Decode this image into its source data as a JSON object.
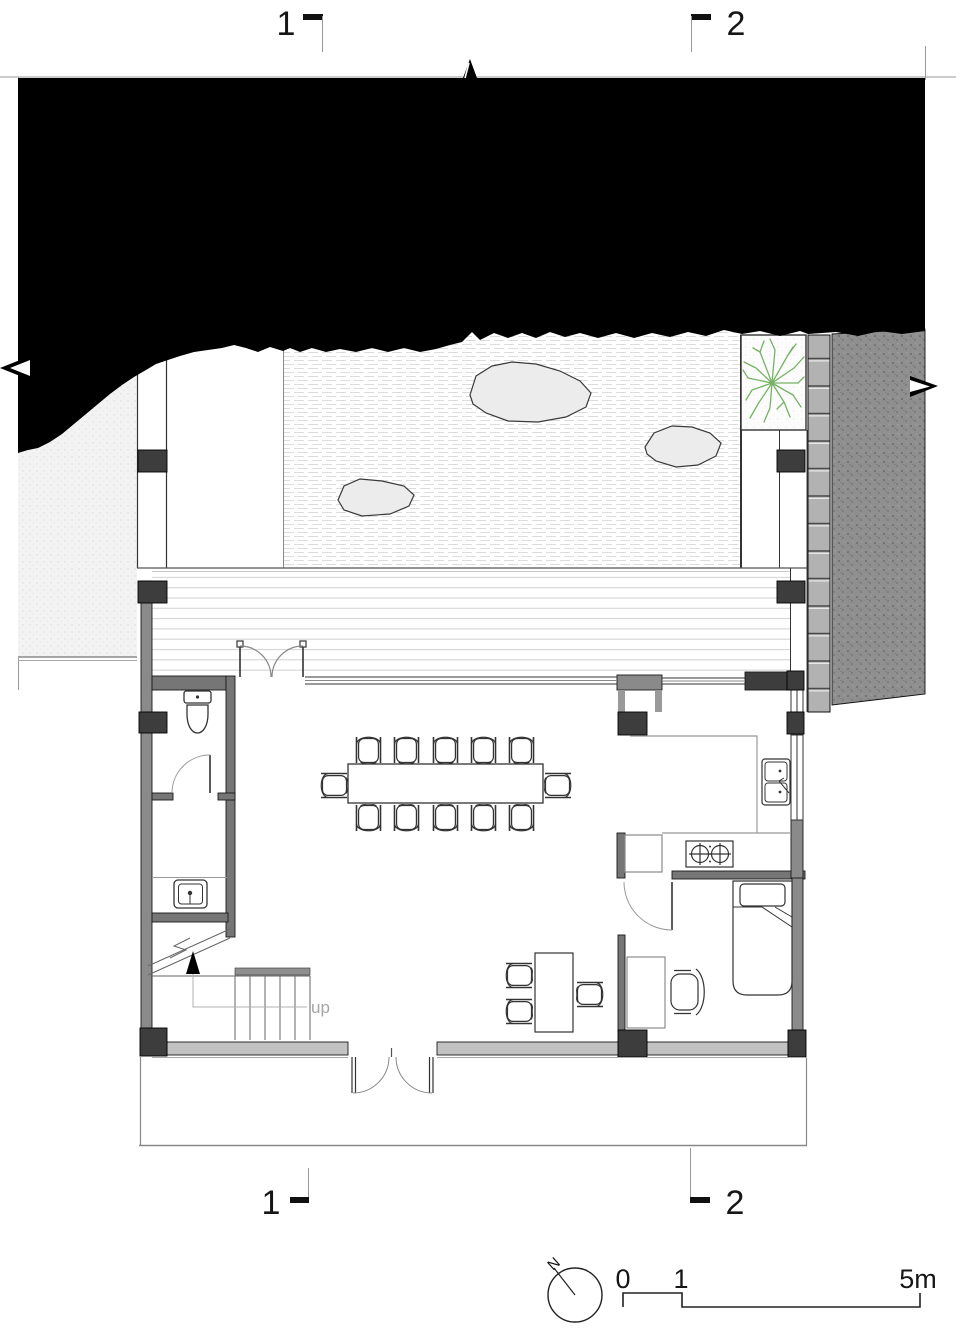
{
  "page": {
    "type": "architectural-floor-plan",
    "background": "#ffffff"
  },
  "labels": {
    "section_marker_1": "1",
    "section_marker_2": "2",
    "stairs_up": "up",
    "north": "N",
    "scale_zero": "0",
    "scale_one": "1",
    "scale_five": "5m"
  },
  "colors": {
    "tree_green": "#74b363",
    "wall_gray": "#767676",
    "exterior_wall_gray": "#8a8a8a",
    "south_wall_gray": "#c2c2c2",
    "column_dark": "#3d3d3d",
    "earth_fill": "#8f8f8f",
    "masonry_fill": "#b2b2b2",
    "site_black": "#000000",
    "stone_fill": "#ececec",
    "deck_line": "#cfcfcf",
    "gravel_line": "#d8d8d8"
  },
  "symbols": [
    "north-arrow-icon",
    "scale-bar",
    "toilet-icon",
    "hand-sink-icon",
    "kitchen-sink-icon",
    "stove-icon",
    "bed-icon",
    "office-chair-icon",
    "dining-table",
    "dining-chair",
    "stair-up-arrow-icon",
    "tree-icon",
    "rock",
    "raked-gravel-hatch",
    "wood-deck-hatch",
    "earth-hatch",
    "masonry-retaining-wall",
    "break-line-arrow"
  ]
}
